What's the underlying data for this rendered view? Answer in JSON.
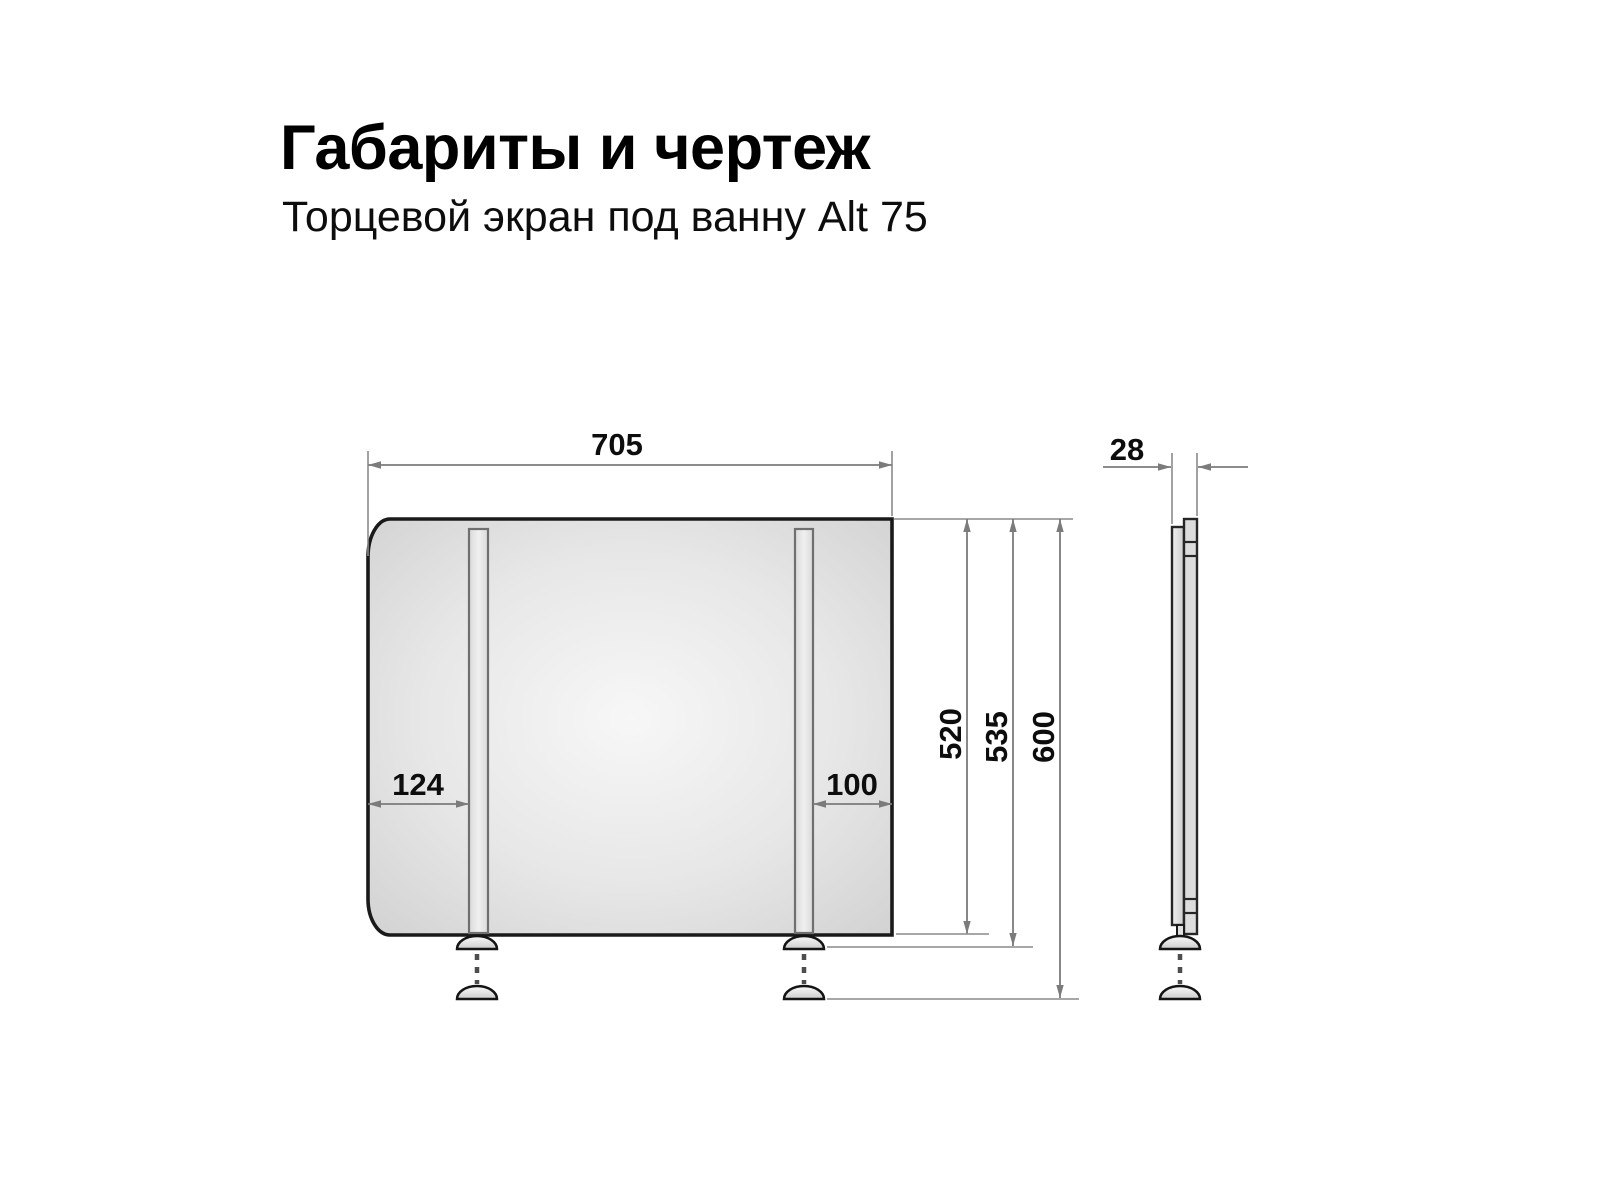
{
  "header": {
    "title": "Габариты и чертеж",
    "subtitle": "Торцевой экран под ванну Alt 75"
  },
  "drawing": {
    "front_view": {
      "width_mm": "705",
      "left_leg_offset_mm": "124",
      "right_leg_offset_mm": "100",
      "panel_height_mm": "520",
      "height_with_feet_mm": "535",
      "height_feet_extended_mm": "600"
    },
    "side_view": {
      "thickness_mm": "28"
    }
  },
  "colors": {
    "background": "#ffffff",
    "panel_edge": "#d3d3d3",
    "panel_center": "#f6f6f6",
    "outline": "#1a1a1a",
    "dimension_line": "#7b7b7b",
    "label_text": "#0d0d0d"
  }
}
